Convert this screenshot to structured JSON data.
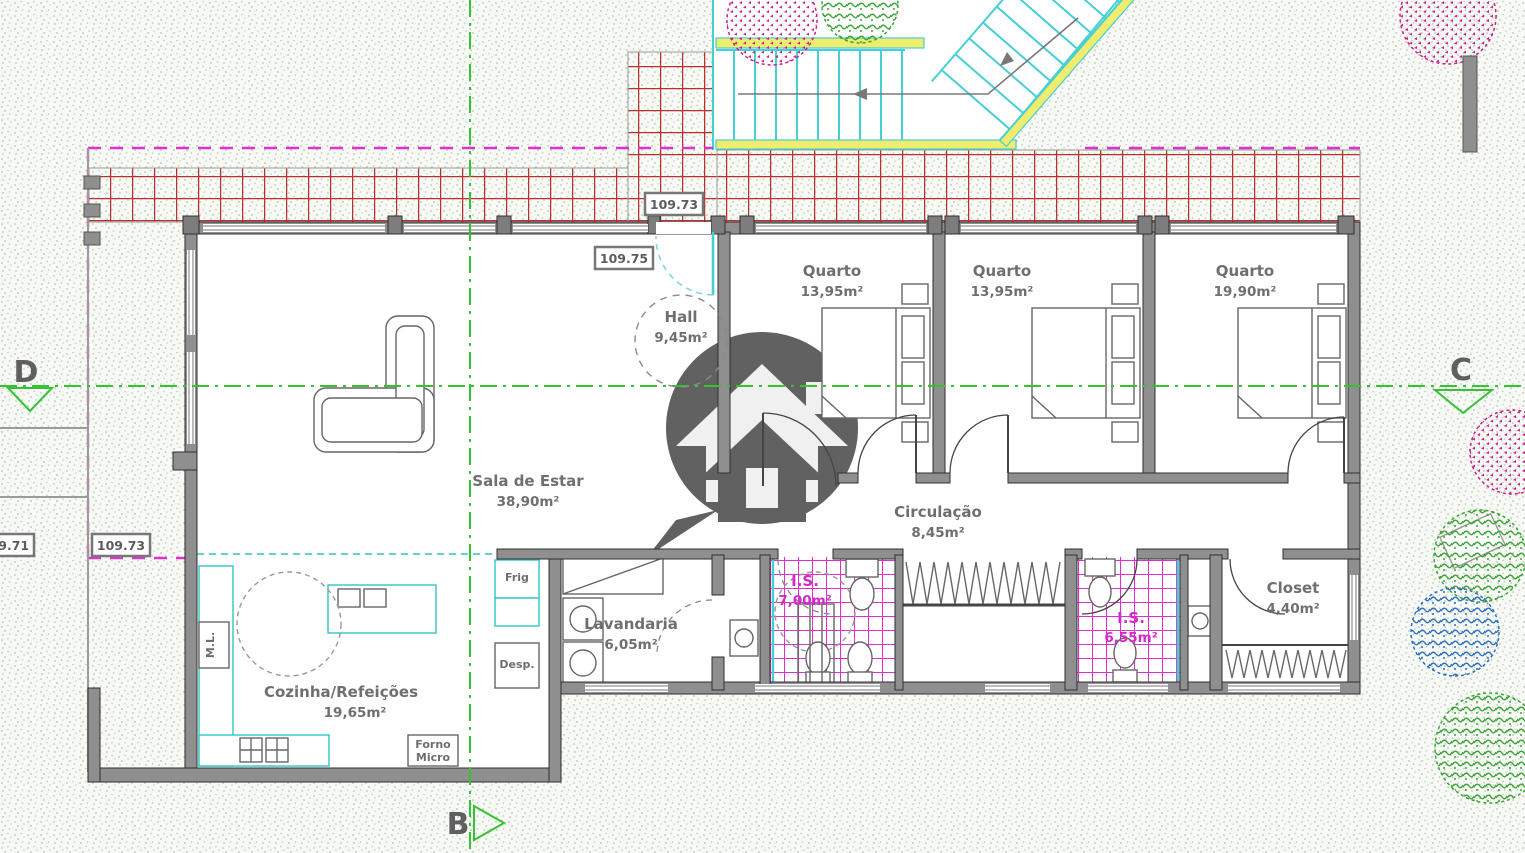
{
  "drawing_type": "architectural floor plan",
  "rooms": {
    "quarto1": {
      "name": "Quarto",
      "area": "13,95m²"
    },
    "quarto2": {
      "name": "Quarto",
      "area": "13,95m²"
    },
    "quarto3": {
      "name": "Quarto",
      "area": "19,90m²"
    },
    "hall": {
      "name": "Hall",
      "area": "9,45m²"
    },
    "sala": {
      "name": "Sala de Estar",
      "area": "38,90m²"
    },
    "circulacao": {
      "name": "Circulação",
      "area": "8,45m²"
    },
    "cozinha": {
      "name": "Cozinha/Refeições",
      "area": "19,65m²"
    },
    "lavandaria": {
      "name": "Lavandaria",
      "area": "6,05m²"
    },
    "is1": {
      "name": "I.S.",
      "area": "7,00m²"
    },
    "is2": {
      "name": "I.S.",
      "area": "6,55m²"
    },
    "closet": {
      "name": "Closet",
      "area": "4,40m²"
    }
  },
  "levels": {
    "terrace": "109.73",
    "entry": "109.75",
    "left_outer": "109.71",
    "left_inner": "109.73"
  },
  "axes": {
    "b": "B",
    "c": "C",
    "d": "D"
  },
  "appliances": {
    "frig": "Frig",
    "desp": "Desp.",
    "forno": "Forno",
    "micro": "Micro",
    "ml": "M.L."
  },
  "icons": {
    "watermark": "house-in-speech-bubble-logo"
  },
  "colors": {
    "wall_gray": "#8f8f8f",
    "tile_red": "#b73131",
    "tile_magenta": "#df2fd0",
    "stair_cyan": "#45cfd6",
    "accent_yellow": "#f0ed6e",
    "axis_green": "#35c335",
    "boundary_magenta": "#e030d0",
    "label_gray": "#6f6f6f",
    "watermark_gray": "#3f3f3f",
    "tree_pink": "#cf1f8f",
    "tree_green": "#3aa435",
    "tree_blue": "#2e6fc0"
  }
}
